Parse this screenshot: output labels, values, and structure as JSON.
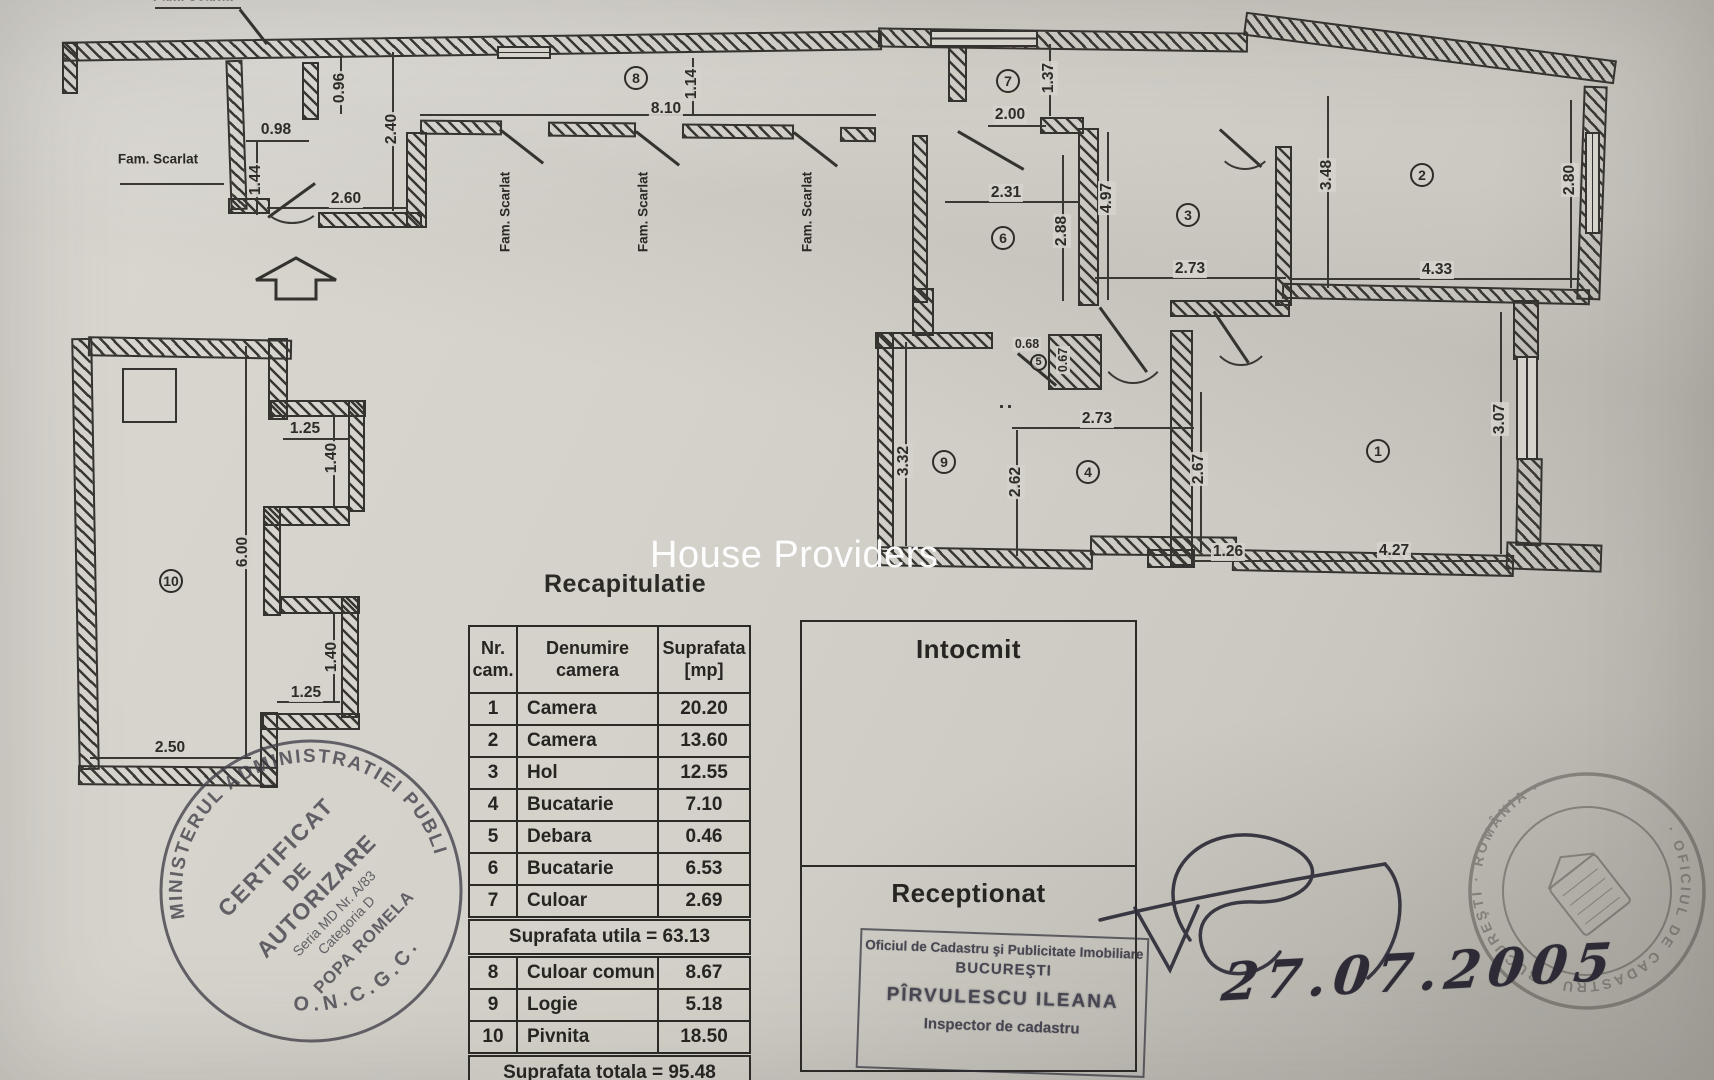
{
  "watermark": "House Providers",
  "plan": {
    "family_label": "Fam. Scarlat",
    "room_markers": [
      {
        "n": "1",
        "x": 1378,
        "y": 451
      },
      {
        "n": "2",
        "x": 1422,
        "y": 175
      },
      {
        "n": "3",
        "x": 1188,
        "y": 215
      },
      {
        "n": "4",
        "x": 1088,
        "y": 472
      },
      {
        "n": "5",
        "x": 1038,
        "y": 362,
        "s": 1
      },
      {
        "n": "6",
        "x": 1003,
        "y": 238
      },
      {
        "n": "7",
        "x": 1008,
        "y": 81
      },
      {
        "n": "8",
        "x": 636,
        "y": 78
      },
      {
        "n": "9",
        "x": 944,
        "y": 462
      },
      {
        "n": "10",
        "x": 171,
        "y": 581
      }
    ],
    "dimensions": [
      {
        "v": "0.96",
        "x": 340,
        "y": 88,
        "o": "v"
      },
      {
        "v": "0.98",
        "x": 276,
        "y": 130,
        "o": "h"
      },
      {
        "v": "2.40",
        "x": 392,
        "y": 129,
        "o": "v"
      },
      {
        "v": "1.44",
        "x": 256,
        "y": 180,
        "o": "v"
      },
      {
        "v": "2.60",
        "x": 346,
        "y": 199,
        "o": "h"
      },
      {
        "v": "8.10",
        "x": 666,
        "y": 109,
        "o": "h"
      },
      {
        "v": "1.14",
        "x": 692,
        "y": 84,
        "o": "v"
      },
      {
        "v": "2.00",
        "x": 1010,
        "y": 115,
        "o": "h"
      },
      {
        "v": "1.37",
        "x": 1049,
        "y": 78,
        "o": "v"
      },
      {
        "v": "2.31",
        "x": 1006,
        "y": 193,
        "o": "h"
      },
      {
        "v": "2.88",
        "x": 1062,
        "y": 231,
        "o": "v"
      },
      {
        "v": "4.97",
        "x": 1107,
        "y": 198,
        "o": "v"
      },
      {
        "v": "2.73",
        "x": 1190,
        "y": 269,
        "o": "h"
      },
      {
        "v": "3.48",
        "x": 1327,
        "y": 175,
        "o": "v"
      },
      {
        "v": "2.80",
        "x": 1570,
        "y": 180,
        "o": "v"
      },
      {
        "v": "4.33",
        "x": 1437,
        "y": 270,
        "o": "h"
      },
      {
        "v": "0.68",
        "x": 1027,
        "y": 344,
        "o": "h",
        "s": 1
      },
      {
        "v": "0.67",
        "x": 1063,
        "y": 360,
        "o": "v",
        "s": 1
      },
      {
        "v": "3.32",
        "x": 904,
        "y": 461,
        "o": "v"
      },
      {
        "v": "2.62",
        "x": 1016,
        "y": 482,
        "o": "v"
      },
      {
        "v": "2.73",
        "x": 1097,
        "y": 419,
        "o": "h"
      },
      {
        "v": "2.67",
        "x": 1199,
        "y": 469,
        "o": "v"
      },
      {
        "v": "1.26",
        "x": 1228,
        "y": 552,
        "o": "h"
      },
      {
        "v": "4.27",
        "x": 1394,
        "y": 551,
        "o": "h"
      },
      {
        "v": "3.07",
        "x": 1500,
        "y": 419,
        "o": "v"
      },
      {
        "v": "1.25",
        "x": 305,
        "y": 429,
        "o": "h"
      },
      {
        "v": "1.40",
        "x": 332,
        "y": 458,
        "o": "v"
      },
      {
        "v": "6.00",
        "x": 243,
        "y": 552,
        "o": "v"
      },
      {
        "v": "1.40",
        "x": 332,
        "y": 657,
        "o": "v"
      },
      {
        "v": "1.25",
        "x": 306,
        "y": 693,
        "o": "h"
      },
      {
        "v": "2.50",
        "x": 170,
        "y": 748,
        "o": "h"
      }
    ],
    "fam_labels": [
      {
        "x": 158,
        "y": 159,
        "o": "h"
      },
      {
        "x": 193,
        "y": -4,
        "o": "h"
      },
      {
        "x": 505,
        "y": 212,
        "o": "v"
      },
      {
        "x": 643,
        "y": 212,
        "o": "v"
      },
      {
        "x": 807,
        "y": 212,
        "o": "v"
      }
    ]
  },
  "recap": {
    "title": "Recapitulatie",
    "headers": {
      "nr": "Nr.\ncam.",
      "name": "Denumire\ncamera",
      "area": "Suprafata\n[mp]"
    },
    "rows": [
      [
        "1",
        "Camera",
        "20.20"
      ],
      [
        "2",
        "Camera",
        "13.60"
      ],
      [
        "3",
        "Hol",
        "12.55"
      ],
      [
        "4",
        "Bucatarie",
        "7.10"
      ],
      [
        "5",
        "Debara",
        "0.46"
      ],
      [
        "6",
        "Bucatarie",
        "6.53"
      ],
      [
        "7",
        "Culoar",
        "2.69"
      ]
    ],
    "subtotal": "Suprafata utila = 63.13",
    "rows2": [
      [
        "8",
        "Culoar comun",
        "8.67"
      ],
      [
        "9",
        "Logie",
        "5.18"
      ],
      [
        "10",
        "Pivnita",
        "18.50"
      ]
    ],
    "total": "Suprafata totala = 95.48"
  },
  "signoff": {
    "intocmit": "Intocmit",
    "receptionat": "Receptionat"
  },
  "office_stamp": {
    "line1": "Oficiul de Cadastru şi Publicitate Imobiliare",
    "line2": "BUCUREŞTI",
    "line3": "PÎRVULESCU ILEANA",
    "line4": "Inspector de cadastru"
  },
  "round_stamp_left": {
    "ring_top": "MINISTERUL ADMINISTRATIEI PUBLICE",
    "ring_bottom": "O.N.C.G.C.",
    "lines": [
      "CERTIFICAT",
      "DE",
      "AUTORIZARE",
      "Seria MD Nr. A/83",
      "Categoria D",
      "POPA ROMELA"
    ]
  },
  "round_stamp_right": {
    "ring": "· OFICIUL DE CADASTRU · BUCUREŞTI · ROMÂNIA ·"
  },
  "date": "27.07.2005"
}
